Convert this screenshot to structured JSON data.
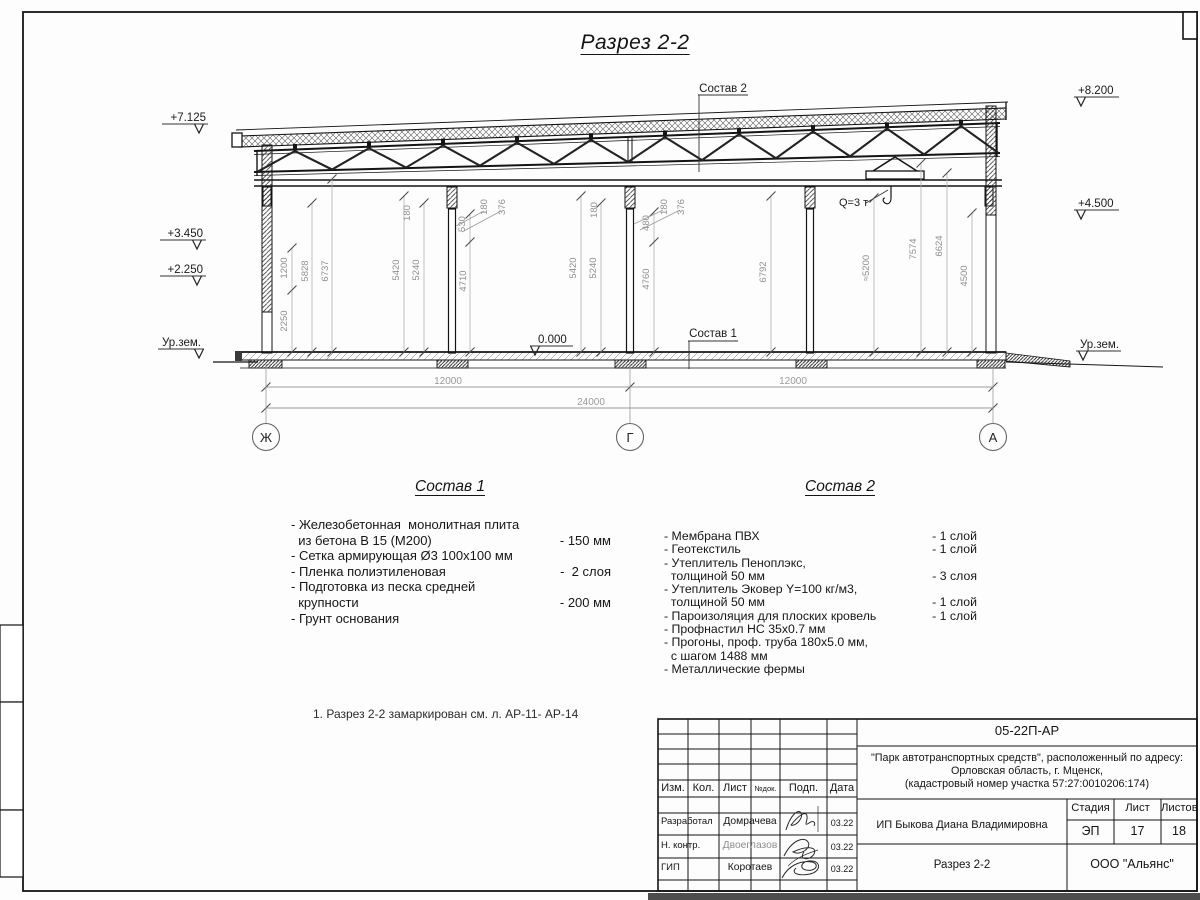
{
  "sheet": {
    "title": "Разрез 2-2",
    "note": "1. Разрез 2-2 замаркирован см. л. АР-11- АР-14"
  },
  "drawing": {
    "callout_top": "Состав 2",
    "callout_bottom": "Состав 1",
    "crane_label": "Q=3 т",
    "zero_mark": "0.000",
    "ground_left": "Ур.зем.",
    "ground_right": "Ур.зем.",
    "elevations_left": [
      "+7.125",
      "+3.450",
      "+2.250"
    ],
    "elevations_right": [
      "+8.200",
      "+4.500"
    ],
    "vertical_dims": [
      "1200",
      "2250",
      "5828",
      "6737",
      "180",
      "5420",
      "5240",
      "530",
      "4710",
      "180",
      "376",
      "180",
      "5420",
      "5240",
      "480",
      "4760",
      "180",
      "376",
      "6792",
      "≈5200",
      "7574",
      "6624",
      "4500"
    ],
    "horizontal_dims": [
      "12000",
      "12000",
      "24000"
    ],
    "axes": [
      "Ж",
      "Г",
      "А"
    ]
  },
  "comp1": {
    "title": "Состав 1",
    "items": [
      {
        "t": "- Железобетонная  монолитная плита",
        "v": ""
      },
      {
        "t": "  из бетона В 15 (М200)",
        "v": "- 150 мм"
      },
      {
        "t": "- Сетка армирующая Ø3 100х100 мм",
        "v": ""
      },
      {
        "t": "- Пленка полиэтиленовая",
        "v": "-  2 слоя"
      },
      {
        "t": "- Подготовка из песка средней",
        "v": ""
      },
      {
        "t": "  крупности",
        "v": "- 200 мм"
      },
      {
        "t": "- Грунт основания",
        "v": ""
      }
    ]
  },
  "comp2": {
    "title": "Состав 2",
    "items": [
      {
        "t": "- Мембрана ПВХ",
        "v": "- 1 слой"
      },
      {
        "t": "- Геотекстиль",
        "v": "- 1 слой"
      },
      {
        "t": "- Утеплитель Пеноплэкс,",
        "v": ""
      },
      {
        "t": "  толщиной 50 мм",
        "v": "- 3 слоя"
      },
      {
        "t": "- Утеплитель Эковер Y=100 кг/м3,",
        "v": ""
      },
      {
        "t": "  толщиной 50 мм",
        "v": "- 1 слой"
      },
      {
        "t": "- Пароизоляция для плоских кровель",
        "v": "- 1 слой"
      },
      {
        "t": "- Профнастил НС 35х0.7 мм",
        "v": ""
      },
      {
        "t": "- Прогоны, проф. труба 180х5.0 мм,",
        "v": ""
      },
      {
        "t": "  с шагом 1488 мм",
        "v": ""
      },
      {
        "t": "- Металлические фермы",
        "v": ""
      }
    ]
  },
  "titleblock": {
    "doc_number": "05-22П-АР",
    "project_lines": [
      "\"Парк автотранспортных средств\",  расположенный по адресу:",
      "Орловская область, г. Мценск,",
      "(кадастровый номер участка 57:27:0010206:174)"
    ],
    "header_cols": [
      "Изм.",
      "Кол.",
      "Лист",
      "№док.",
      "Подп.",
      "Дата"
    ],
    "sign_rows": [
      {
        "role": "Разработал",
        "name": "Домрачева",
        "date": "03.22"
      },
      {
        "role": "Н. контр.",
        "name": "Двоеглазов",
        "date": "03.22"
      },
      {
        "role": "ГИП",
        "name": "Коротаев",
        "date": "03.22"
      }
    ],
    "client": "ИП Быкова Диана Владимировна",
    "stage_label": "Стадия",
    "sheet_label": "Лист",
    "sheets_label": "Листов",
    "stage": "ЭП",
    "sheet": "17",
    "sheets": "18",
    "drawing_name": "Разрез 2-2",
    "company": "ООО \"Альянс\""
  }
}
